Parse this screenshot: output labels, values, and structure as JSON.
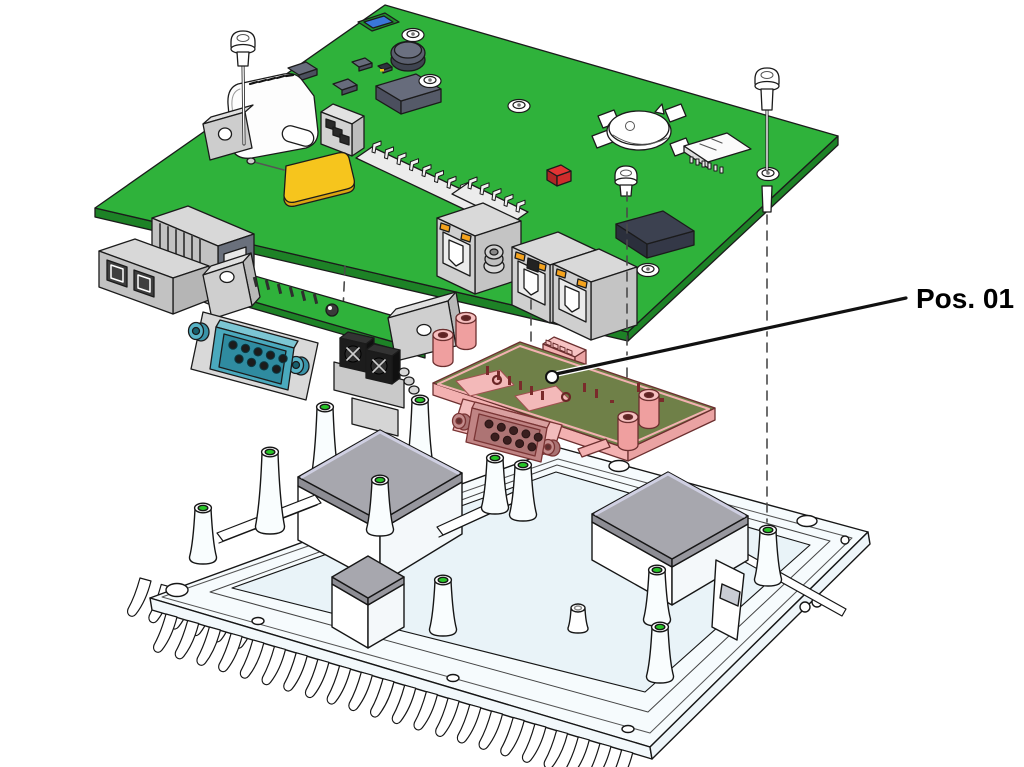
{
  "diagram": {
    "type": "exploded-view",
    "subject": "embedded-computer-assembly",
    "parts": [
      "main-pcb",
      "serial-adapter-board",
      "interface-board",
      "heatsink-chassis",
      "mounting-screws"
    ],
    "highlighted_part": "interface-board"
  },
  "callout": {
    "label": "Pos. 01"
  },
  "colors": {
    "pcb-green": "#2fb23b",
    "pcb-green-dark": "#1d8226",
    "pcb-olive": "#6f8048",
    "hl-pink": "#f3b1b1",
    "hl-pink-light": "#f7c3c3",
    "hl-pink-deep": "#eaa3a3",
    "pink-body": "#c08484",
    "pad-yellow": "#f6c51d",
    "pad-yellow-dark": "#d9a411",
    "pad-gray": "#a7a7ae",
    "pad-gray-dark": "#8d8d94",
    "insert-green": "#27c427",
    "db9-teal": "#4aa9bd",
    "db9-teal-dark": "#2f8ba0",
    "led-orange": "#f5a31d",
    "metal-light": "#d8d8d8",
    "metal-mid": "#c2c2c2",
    "chip-slate": "#676c7c",
    "chip-dark": "#3c4150",
    "red-comp": "#e23434",
    "blue-comp": "#3a77d9",
    "hs-white": "#f6fbfd",
    "hs-floor": "#e9f3f8",
    "line": "#1b1b1b"
  }
}
